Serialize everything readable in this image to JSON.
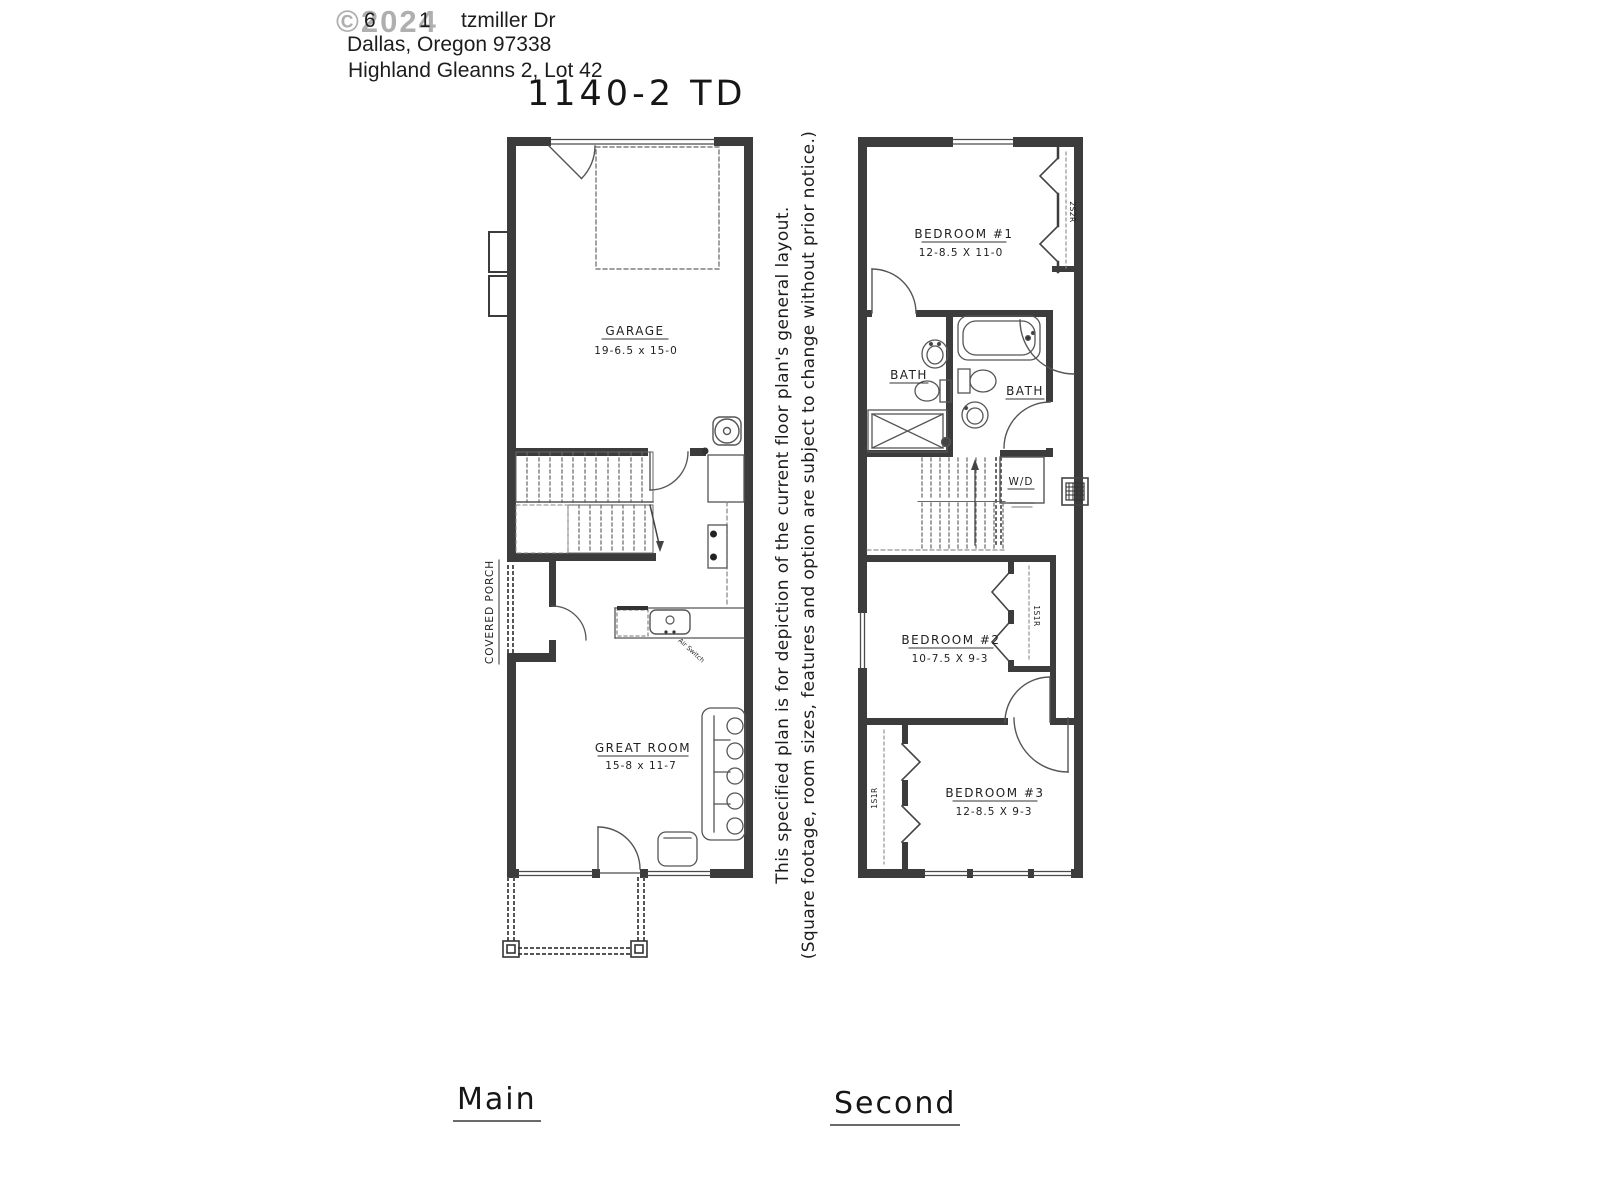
{
  "page": {
    "watermark": "©2024",
    "address": {
      "digit_a": "6",
      "digit_b": "1",
      "line1_street": "tzmiller Dr",
      "line2": "Dallas, Oregon 97338",
      "line3": "Highland Gleanns 2, Lot 42"
    },
    "plan_title": "1140-2 TD",
    "disclaimer_line1": "This specified plan is for depiction of the current floor plan's general layout.",
    "disclaimer_line2": "(Square footage, room sizes, features and option are subject to change without prior notice.)",
    "floor_labels": {
      "main": "Main",
      "second": "Second"
    }
  },
  "main_floor": {
    "garage": {
      "name": "GARAGE",
      "dims": "19-6.5 x 15-0"
    },
    "great_room": {
      "name": "GREAT ROOM",
      "dims": "15-8 x 11-7"
    },
    "covered_porch": "COVERED PORCH",
    "air_switch": "Air Switch"
  },
  "second_floor": {
    "bedroom1": {
      "name": "BEDROOM #1",
      "dims": "12-8.5 X 11-0",
      "closet": "2S2R"
    },
    "bath1": "BATH",
    "bath2": "BATH",
    "laundry": "W/D",
    "bedroom2": {
      "name": "BEDROOM #2",
      "dims": "10-7.5 X 9-3",
      "closet": "1S1R"
    },
    "bedroom3": {
      "name": "BEDROOM #3",
      "dims": "12-8.5 X 9-3",
      "closet": "1S1R"
    }
  },
  "colors": {
    "wall": "#3c3c3c",
    "line": "#555555",
    "text": "#1f1f1f",
    "watermark": "#a2a2a2"
  }
}
